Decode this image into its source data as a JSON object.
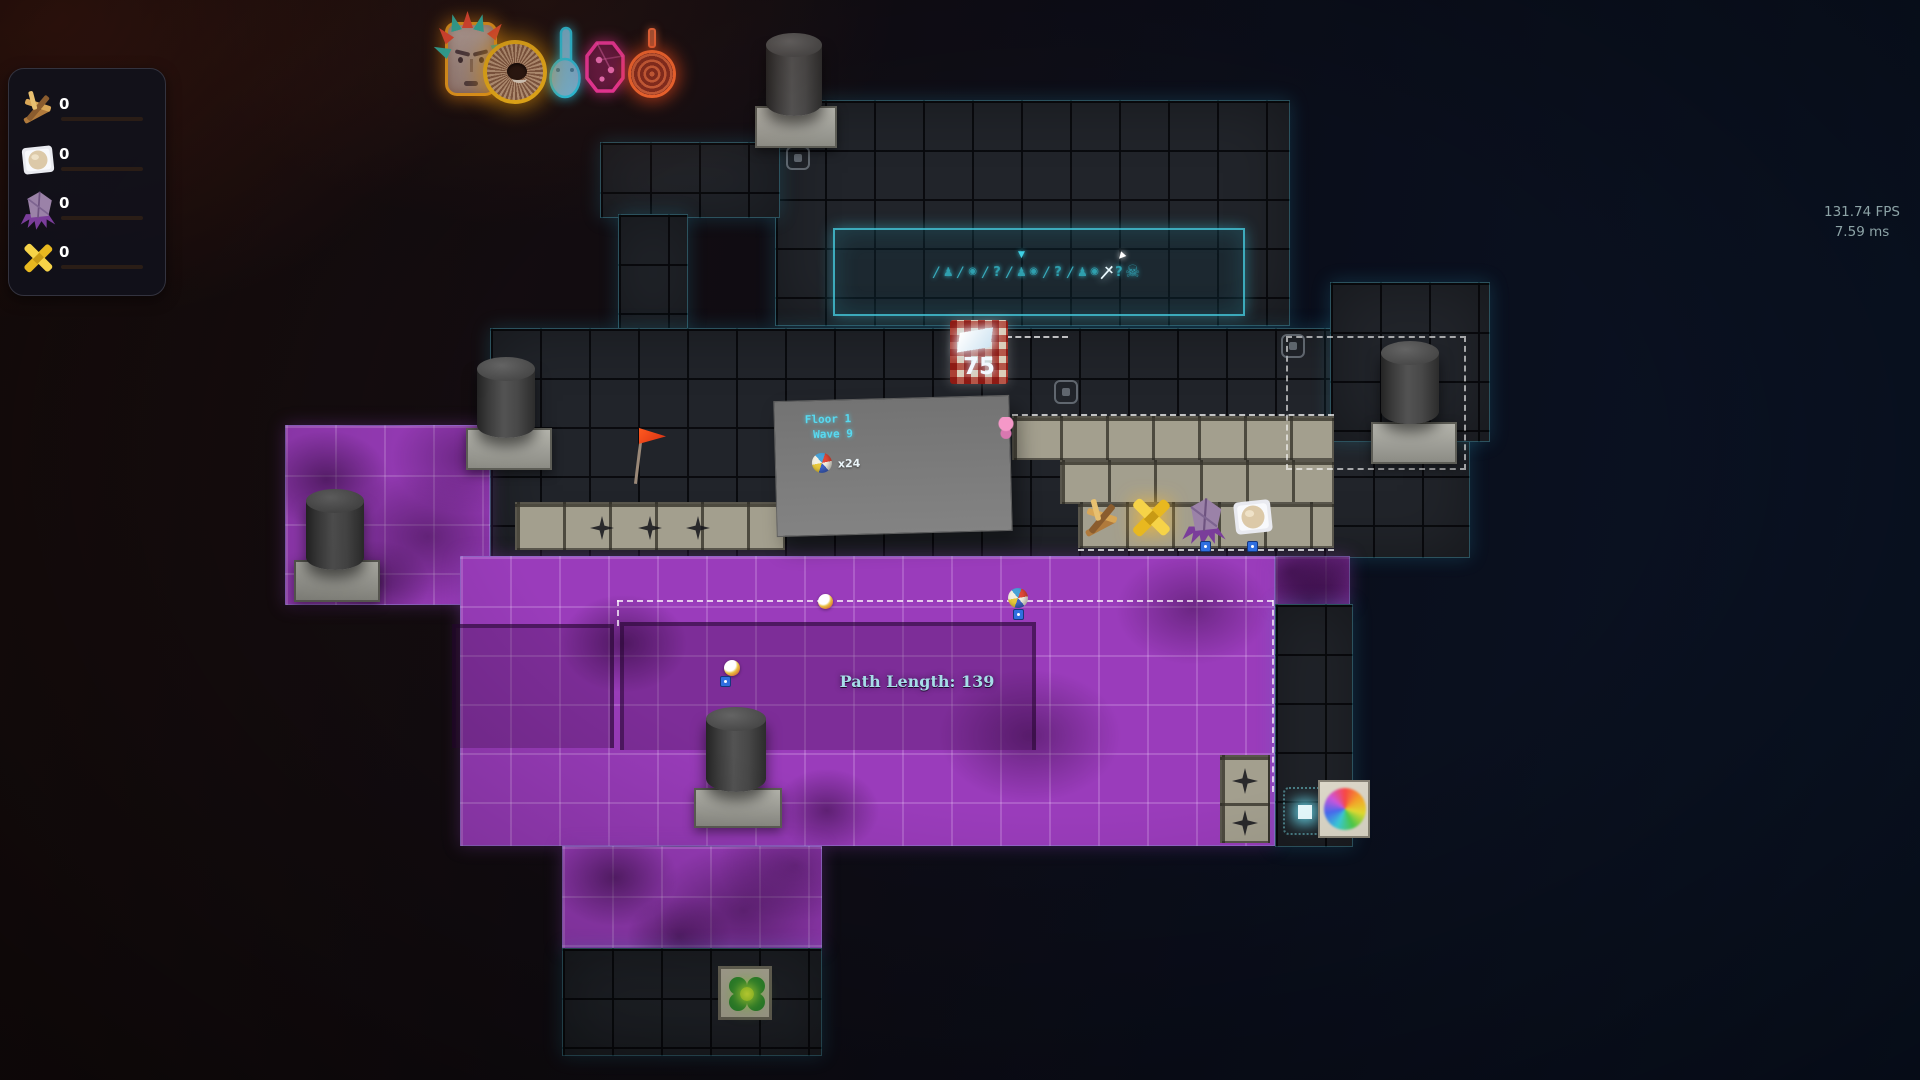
{
  "perf": {
    "fps": "131.74 FPS",
    "frame_time": "7.59 ms"
  },
  "hud": {
    "resources": [
      {
        "icon": "wood-sticks-icon",
        "value": "0"
      },
      {
        "icon": "egg-crate-icon",
        "value": "0"
      },
      {
        "icon": "purple-shard-icon",
        "value": "0"
      },
      {
        "icon": "gold-cross-icon",
        "value": "0"
      }
    ]
  },
  "top_icons": [
    {
      "name": "totem-mask-icon",
      "glow": "#ffab1f"
    },
    {
      "name": "shell-wheel-icon",
      "glow": "#ffc01a"
    },
    {
      "name": "neon-hand-icon",
      "glow": "#25d5f5"
    },
    {
      "name": "neon-die-icon",
      "glow": "#ff38a8"
    },
    {
      "name": "spiral-disc-icon",
      "glow": "#ff6a30"
    }
  ],
  "floor_panel": {
    "floor": "Floor 1",
    "wave": "Wave 9",
    "ball_count": "x24"
  },
  "price_tag": {
    "value": "75"
  },
  "path_label": {
    "text": "Path Length: 139"
  },
  "wave_bar": {
    "icons": [
      {
        "g": "slash"
      },
      {
        "g": "enemy"
      },
      {
        "g": "slash"
      },
      {
        "g": "orb"
      },
      {
        "g": "slash"
      },
      {
        "g": "question"
      },
      {
        "g": "slash"
      },
      {
        "g": "enemy",
        "marker": "teal"
      },
      {
        "g": "orb"
      },
      {
        "g": "slash"
      },
      {
        "g": "question"
      },
      {
        "g": "slash"
      },
      {
        "g": "enemy"
      },
      {
        "g": "orb"
      },
      {
        "g": "bigsword",
        "marker": "white"
      },
      {
        "g": "question"
      },
      {
        "g": "skull"
      }
    ]
  },
  "colors": {
    "accent_cyan": "#3fd2e6",
    "corruption_purple": "#9a3cbb",
    "neon_orange": "#ffb020",
    "neon_pink": "#ff3da8",
    "neon_blue": "#35c8f0"
  }
}
